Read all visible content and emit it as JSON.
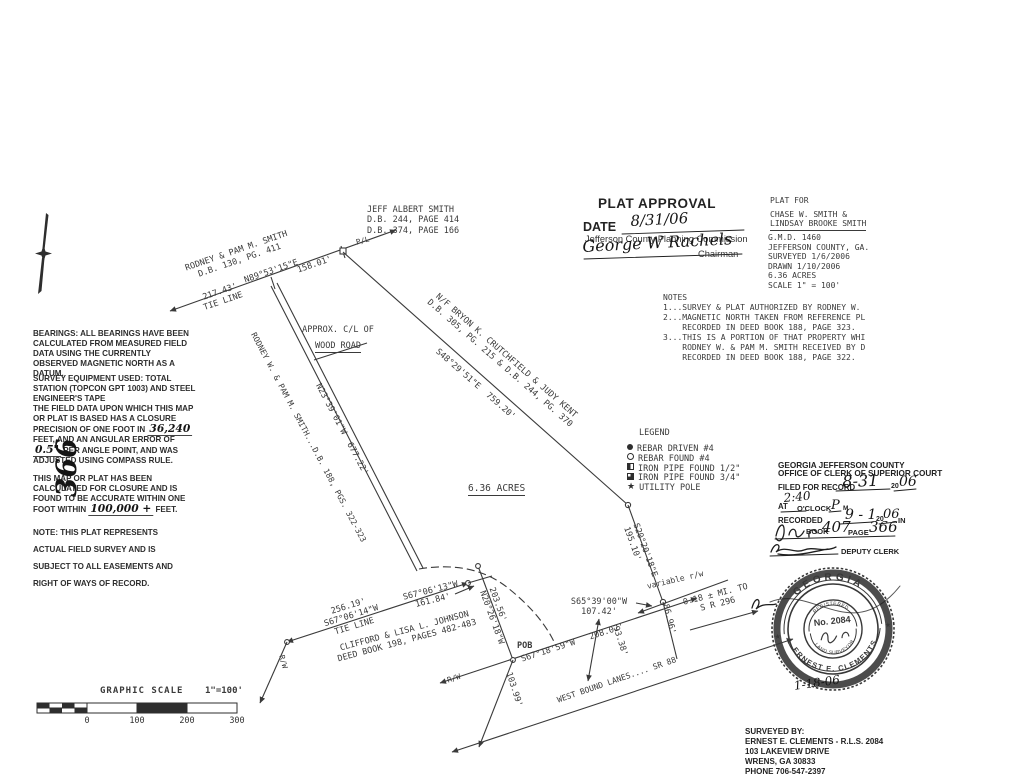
{
  "ink": "#3a3a3a",
  "handwriting_color": "#151515",
  "blocks": {
    "jeff_smith": "JEFF ALBERT SMITH\nD.B. 244, PAGE 414\nD.B. 374, PAGE 166",
    "notes": "NOTES\n1...SURVEY & PLAT AUTHORIZED BY RODNEY W.\n2...MAGNETIC NORTH TAKEN FROM REFERENCE PL\n    RECORDED IN DEED BOOK 188, PAGE 323.\n3...THIS IS A PORTION OF THAT PROPERTY WHI\n    RODNEY W. & PAM M. SMITH RECEIVED BY D\n    RECORDED IN DEED BOOK 188, PAGE 322.",
    "surveyed_by": "SURVEYED BY:\nERNEST E. CLEMENTS - R.L.S. 2084\n103 LAKEVIEW DRIVE\nWRENS, GA 30833\nPHONE 706-547-2397",
    "approx_cl_1": "APPROX. C/L OF",
    "approx_cl_2": "WOOD ROAD"
  },
  "plat_approval": {
    "title": "PLAT APPROVAL",
    "date_label": "DATE",
    "date_value": "8/31/06",
    "commission": "Jefferson County Planning Commission",
    "signature": "George W Rachels",
    "signer_title": "Chairman"
  },
  "plat_for": {
    "label": "PLAT FOR",
    "name_1": "CHASE W. SMITH &",
    "name_2": "LINDSAY BROOKE SMITH",
    "details": "G.M.D. 1460\nJEFFERSON COUNTY, GA.\nSURVEYED 1/6/2006\nDRAWN 1/10/2006\n6.36 ACRES\nSCALE 1\" = 100'"
  },
  "left_column": {
    "bearings": "BEARINGS: ALL BEARINGS HAVE BEEN CALCULATED FROM MEASURED FIELD DATA USING THE CURRENTLY OBSERVED MAGNETIC NORTH AS A DATUM.",
    "equipment": "SURVEY EQUIPMENT USED: TOTAL STATION (TOPCON GPT 1003) AND STEEL ENGINEER'S TAPE",
    "closure_pre": "THE FIELD DATA UPON WHICH THIS MAP OR PLAT IS BASED HAS A CLOSURE PRECISION OF ONE FOOT IN ",
    "closure_hw1": "36,240",
    "closure_mid": " FEET, AND AN ANGULAR ERROR OF ",
    "closure_hw2": "0.5\"",
    "closure_post": " PER ANGLE POINT, AND WAS ADJUSTED USING COMPASS RULE.",
    "accuracy_pre": "THIS MAP OR PLAT HAS BEEN CALCULATED FOR CLOSURE AND IS FOUND TO BE ACCURATE WITHIN ONE FOOT WITHIN ",
    "accuracy_hw": "100,000 +",
    "accuracy_post": " FEET.",
    "note": "NOTE: THIS PLAT REPRESENTS ACTUAL FIELD SURVEY AND IS SUBJECT TO ALL EASEMENTS AND RIGHT OF WAYS OF RECORD.",
    "recording_page_number": "366"
  },
  "survey_labels": {
    "rodney_top": "RODNEY & PAM M. SMITH\nD.B. 130, PG. 411",
    "n89": "N89°53'15\"E",
    "d158": "158.01'",
    "tie217": "217.43'\nTIE LINE",
    "pl": "P/L",
    "crutchfield": "N/F BRYON K. CRUTCHFIELD & JUDY KENT\nD.B. 305, PG. 215 & D.B. 244, PG. 370",
    "s48": "S48°29'51\"E  759.20'",
    "n23": "N23°39'01\"W  677.22'",
    "rodney_road": "RODNEY W. & PAM M. SMITH...D.B. 188, PGS. 322-323",
    "acres": "6.36 ACRES",
    "s20": "S20°20'18\"E\n195.10'",
    "n20": "203.56'\nN20°26'18\"W",
    "s65": "S65°39'00\"W\n107.42'",
    "pob": "POB",
    "s67_road": "S67°18'59\"W   208.02'",
    "west_bound": "WEST BOUND LANES.... SR 88",
    "d10399": "103.99'",
    "d9338": "93.38'",
    "d8696": "86.96'",
    "variable_rw": "variable r/w",
    "mi296": "0.18 ± MI. TO\nS R 296",
    "tie256": "256.19'\nS67°06'14\"W\nTIE LINE",
    "s6713": "S67°06'13\"W\n161.84'",
    "johnson": "CLIFFORD & LISA L. JOHNSON\nDEED BOOK 198, PAGES 482-483",
    "rw_1": "R/W",
    "rw_2": "R/W"
  },
  "legend": {
    "title": "LEGEND",
    "items": [
      {
        "symbol": "filled-circle",
        "label": "REBAR DRIVEN #4"
      },
      {
        "symbol": "open-circle",
        "label": "REBAR FOUND #4"
      },
      {
        "symbol": "half-filled-square",
        "label": "IRON PIPE FOUND 1/2\""
      },
      {
        "symbol": "three-quarter-filled-square",
        "label": "IRON PIPE FOUND 3/4\""
      },
      {
        "symbol": "star",
        "label": "UTILITY POLE"
      }
    ],
    "star_glyph": "★"
  },
  "clerk": {
    "header_1": "GEORGIA JEFFERSON COUNTY",
    "header_2": "OFFICE OF CLERK OF SUPERIOR COURT",
    "filed_label": "FILED FOR RECORD",
    "filed_value": "8-31",
    "century": "20",
    "filed_year": "06",
    "at_label": "AT",
    "time_value": "2:40",
    "oclock_label": "O'CLOCK",
    "meridiem_value": "P",
    "m_label": "M",
    "recorded_label": "RECORDED",
    "recorded_value": "9 - 1",
    "recorded_year": "06",
    "in_label": "IN",
    "book_label": "BOOK",
    "book_value": "407",
    "page_label": "PAGE",
    "page_value": "366",
    "deputy_label": "DEPUTY CLERK"
  },
  "seal": {
    "state": "GEORGIA",
    "registered": "REGISTERED",
    "number": "No. 2084",
    "surveyor": "LAND SURVEYOR",
    "name": "ERNEST E. CLEMENTS",
    "star": "★",
    "date": "1-18-06"
  },
  "scale": {
    "title": "GRAPHIC SCALE",
    "ratio": "1\"=100'",
    "ticks": [
      "0",
      "100",
      "200",
      "300"
    ]
  }
}
